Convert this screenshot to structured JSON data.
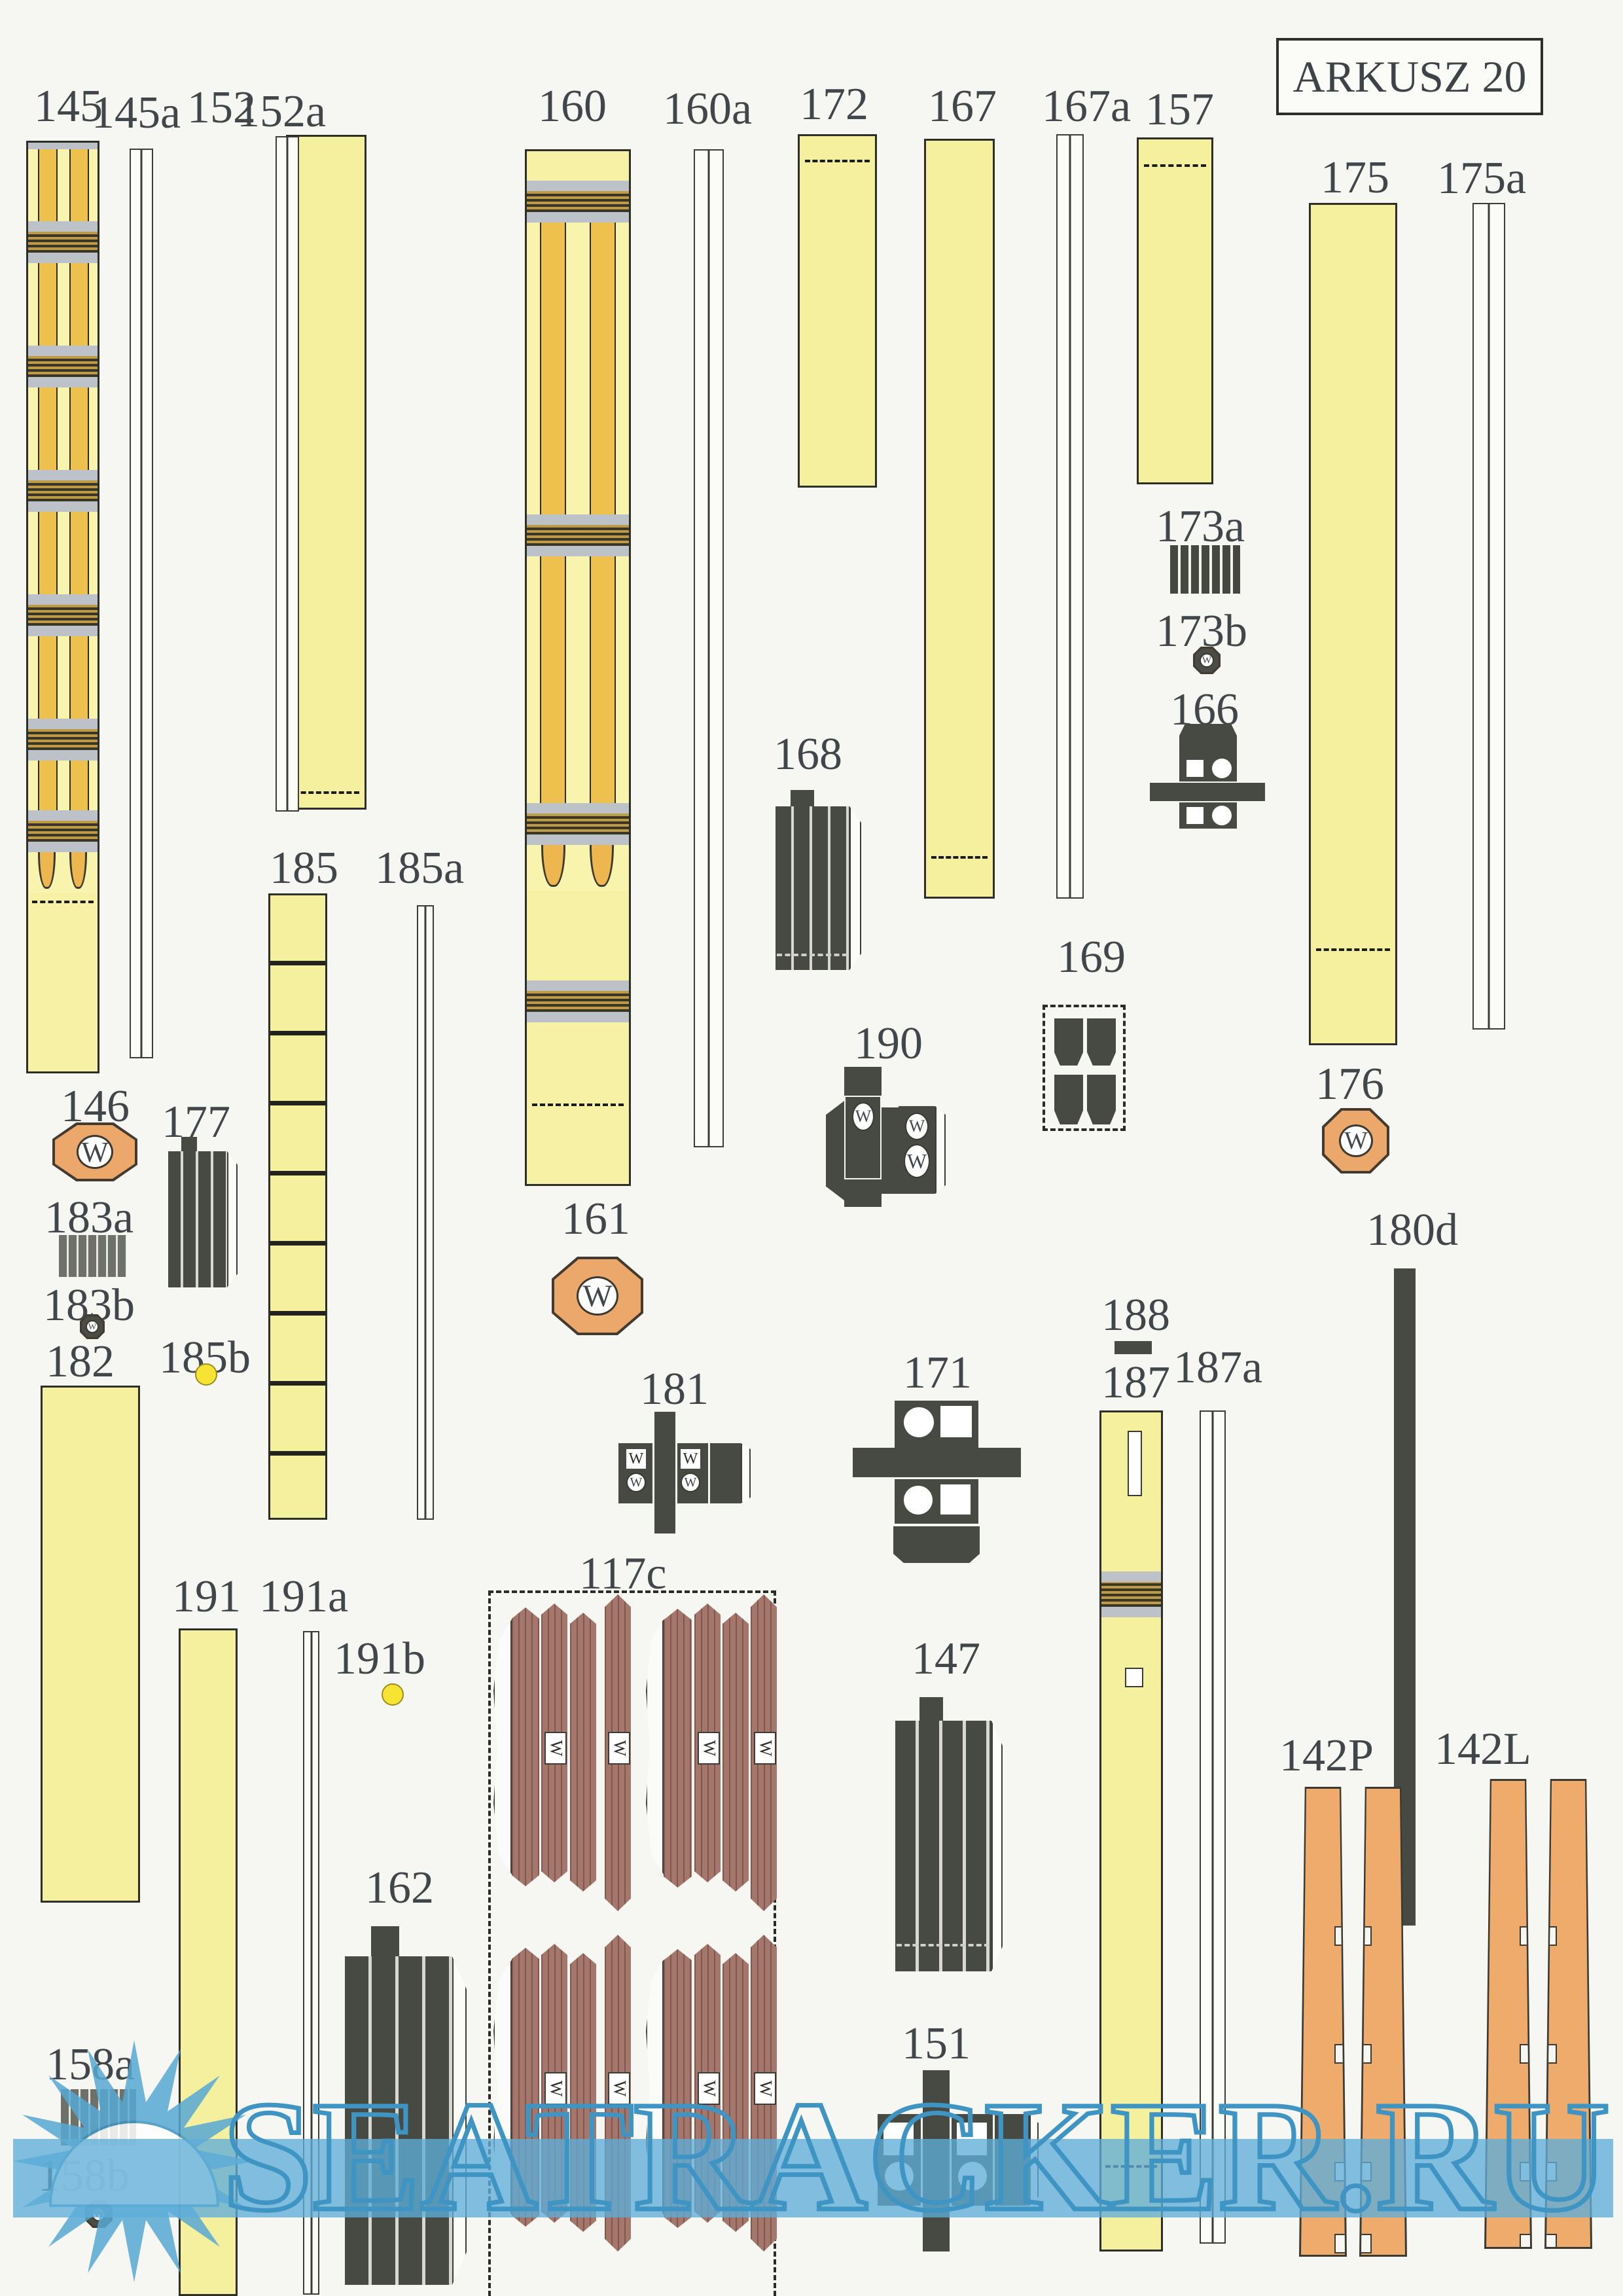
{
  "sheet": {
    "title": "ARKUSZ 20",
    "watermark_text": "SEATRACKER.RU"
  },
  "marks": {
    "w": "W"
  },
  "part_labels": {
    "145": "145",
    "145a": "145a",
    "152": "152",
    "152a": "152a",
    "160": "160",
    "160a": "160a",
    "172": "172",
    "167": "167",
    "167a": "167a",
    "157": "157",
    "175": "175",
    "175a": "175a",
    "146": "146",
    "177": "177",
    "183a": "183a",
    "183b": "183b",
    "182": "182",
    "185": "185",
    "185a": "185a",
    "185b": "185b",
    "161": "161",
    "168": "168",
    "190": "190",
    "169": "169",
    "166": "166",
    "173a": "173a",
    "173b": "173b",
    "176": "176",
    "180d": "180d",
    "188": "188",
    "187": "187",
    "187a": "187a",
    "181": "181",
    "171": "171",
    "191": "191",
    "191a": "191a",
    "191b": "191b",
    "117c": "117c",
    "162": "162",
    "147": "147",
    "151": "151",
    "158a": "158a",
    "158b": "158b",
    "142P": "142P",
    "142L": "142L"
  },
  "colors": {
    "paper": "#f6f6f2",
    "pale_yellow": "#f4f09e",
    "mast_pale": "#f8f3ad",
    "mast_orange": "#eec14f",
    "gray_band": "#bdc1c8",
    "woven_band": "#bd9a47",
    "dark_part": "#474a42",
    "plank_brown": "#a5766b",
    "octagon_orange": "#eca86a",
    "strip_orange": "#eeab6c",
    "dot_yellow": "#f6e334",
    "watermark_blue": "#3e94c3"
  }
}
